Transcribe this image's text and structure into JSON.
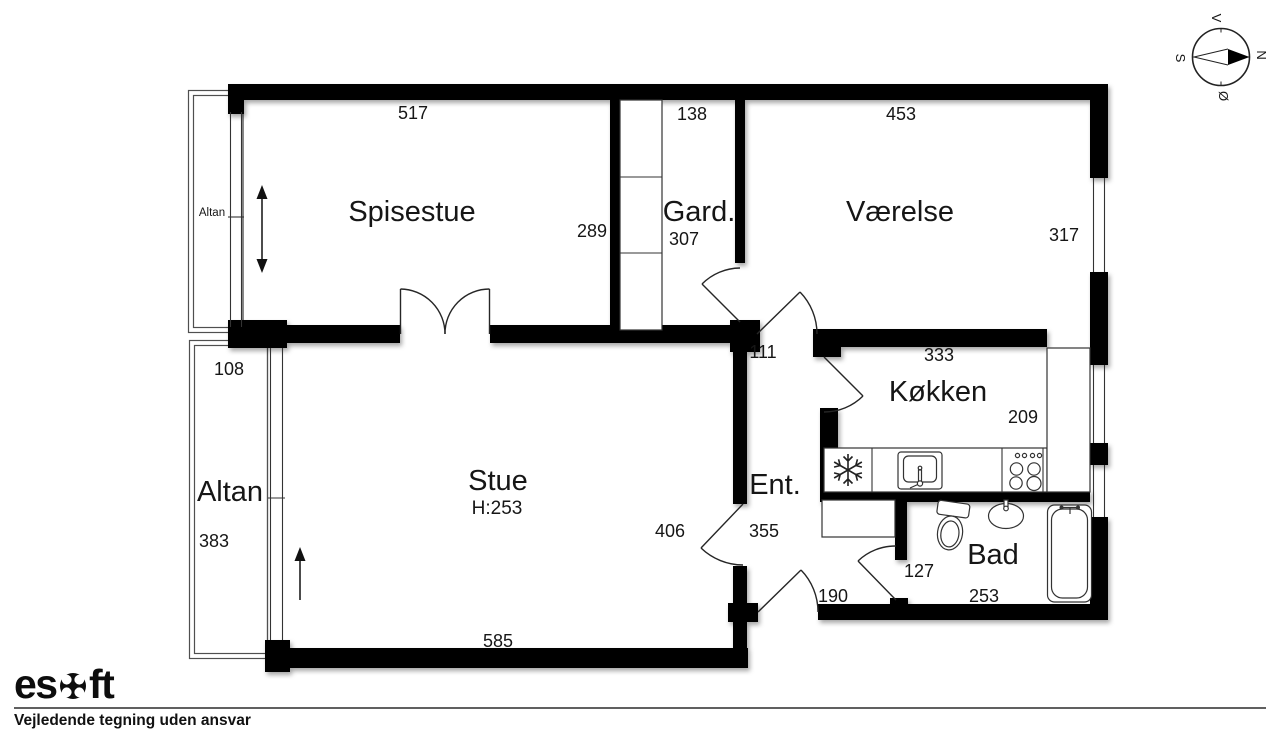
{
  "plan": {
    "rooms": {
      "spisestue": {
        "label": "Spisestue",
        "width": "517",
        "depth": "289"
      },
      "gard": {
        "label": "Gard.",
        "width": "138",
        "depth": "307"
      },
      "vaerelse": {
        "label": "Værelse",
        "width": "453",
        "depth": "317"
      },
      "koekken": {
        "label": "Køkken",
        "width": "333",
        "depth": "209"
      },
      "stue": {
        "label": "Stue",
        "ceiling_height": "H:253",
        "width": "585",
        "depth": "406"
      },
      "ent": {
        "label": "Ent.",
        "depth": "355",
        "opening_width": "111",
        "front_door_width": "190"
      },
      "bad": {
        "label": "Bad",
        "width": "253",
        "depth": "127"
      },
      "altan_top": {
        "label": "Altan"
      },
      "altan_bottom": {
        "label": "Altan",
        "width": "108",
        "depth": "383"
      }
    },
    "compass": {
      "north": "N",
      "south": "S",
      "west": "V",
      "east": "Ø"
    }
  },
  "footer": {
    "brand_prefix": "es",
    "brand_suffix": "ft",
    "disclaimer": "Vejledende tegning uden ansvar"
  },
  "colors": {
    "wall": "#000000",
    "background": "#ffffff"
  }
}
